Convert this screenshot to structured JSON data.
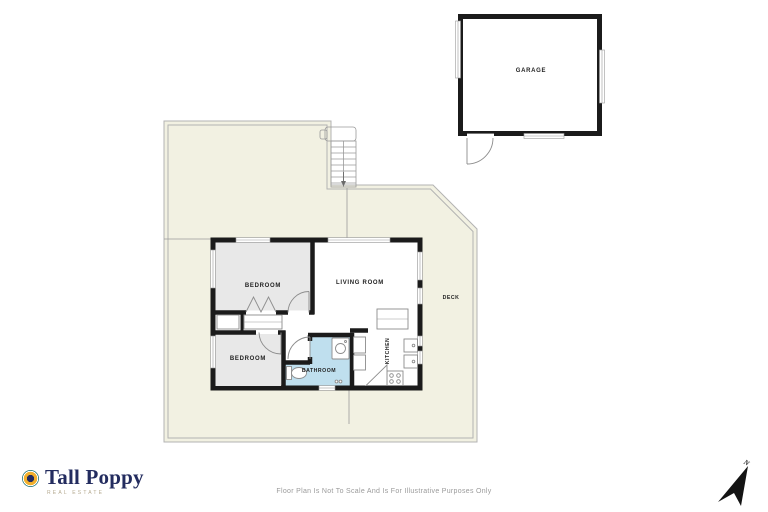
{
  "branding": {
    "name": "Tall Poppy",
    "tagline": "REAL ESTATE"
  },
  "footer": {
    "disclaimer": "Floor Plan Is Not To Scale And Is For Illustrative Purposes Only"
  },
  "compass": {
    "label": "N"
  },
  "floor_plan": {
    "rooms": [
      {
        "id": "garage",
        "label": "GARAGE"
      },
      {
        "id": "bedroom-1",
        "label": "BEDROOM"
      },
      {
        "id": "living-room",
        "label": "LIVING ROOM"
      },
      {
        "id": "bedroom-2",
        "label": "BEDROOM"
      },
      {
        "id": "bathroom",
        "label": "BATHROOM"
      },
      {
        "id": "kitchen",
        "label": "KITCHEN"
      },
      {
        "id": "deck",
        "label": "DECK"
      }
    ],
    "colors": {
      "wall": "#1b1b1b",
      "room_fill_gray": "#e8e8e8",
      "bathroom_fill_blue": "#bfdfee",
      "deck_fill_cream": "#f2f1e2",
      "outline_gray": "#b3b3b3",
      "logo_navy": "#232c5f",
      "logo_teal": "#2f7e7d",
      "logo_gold": "#f2b02c"
    }
  }
}
